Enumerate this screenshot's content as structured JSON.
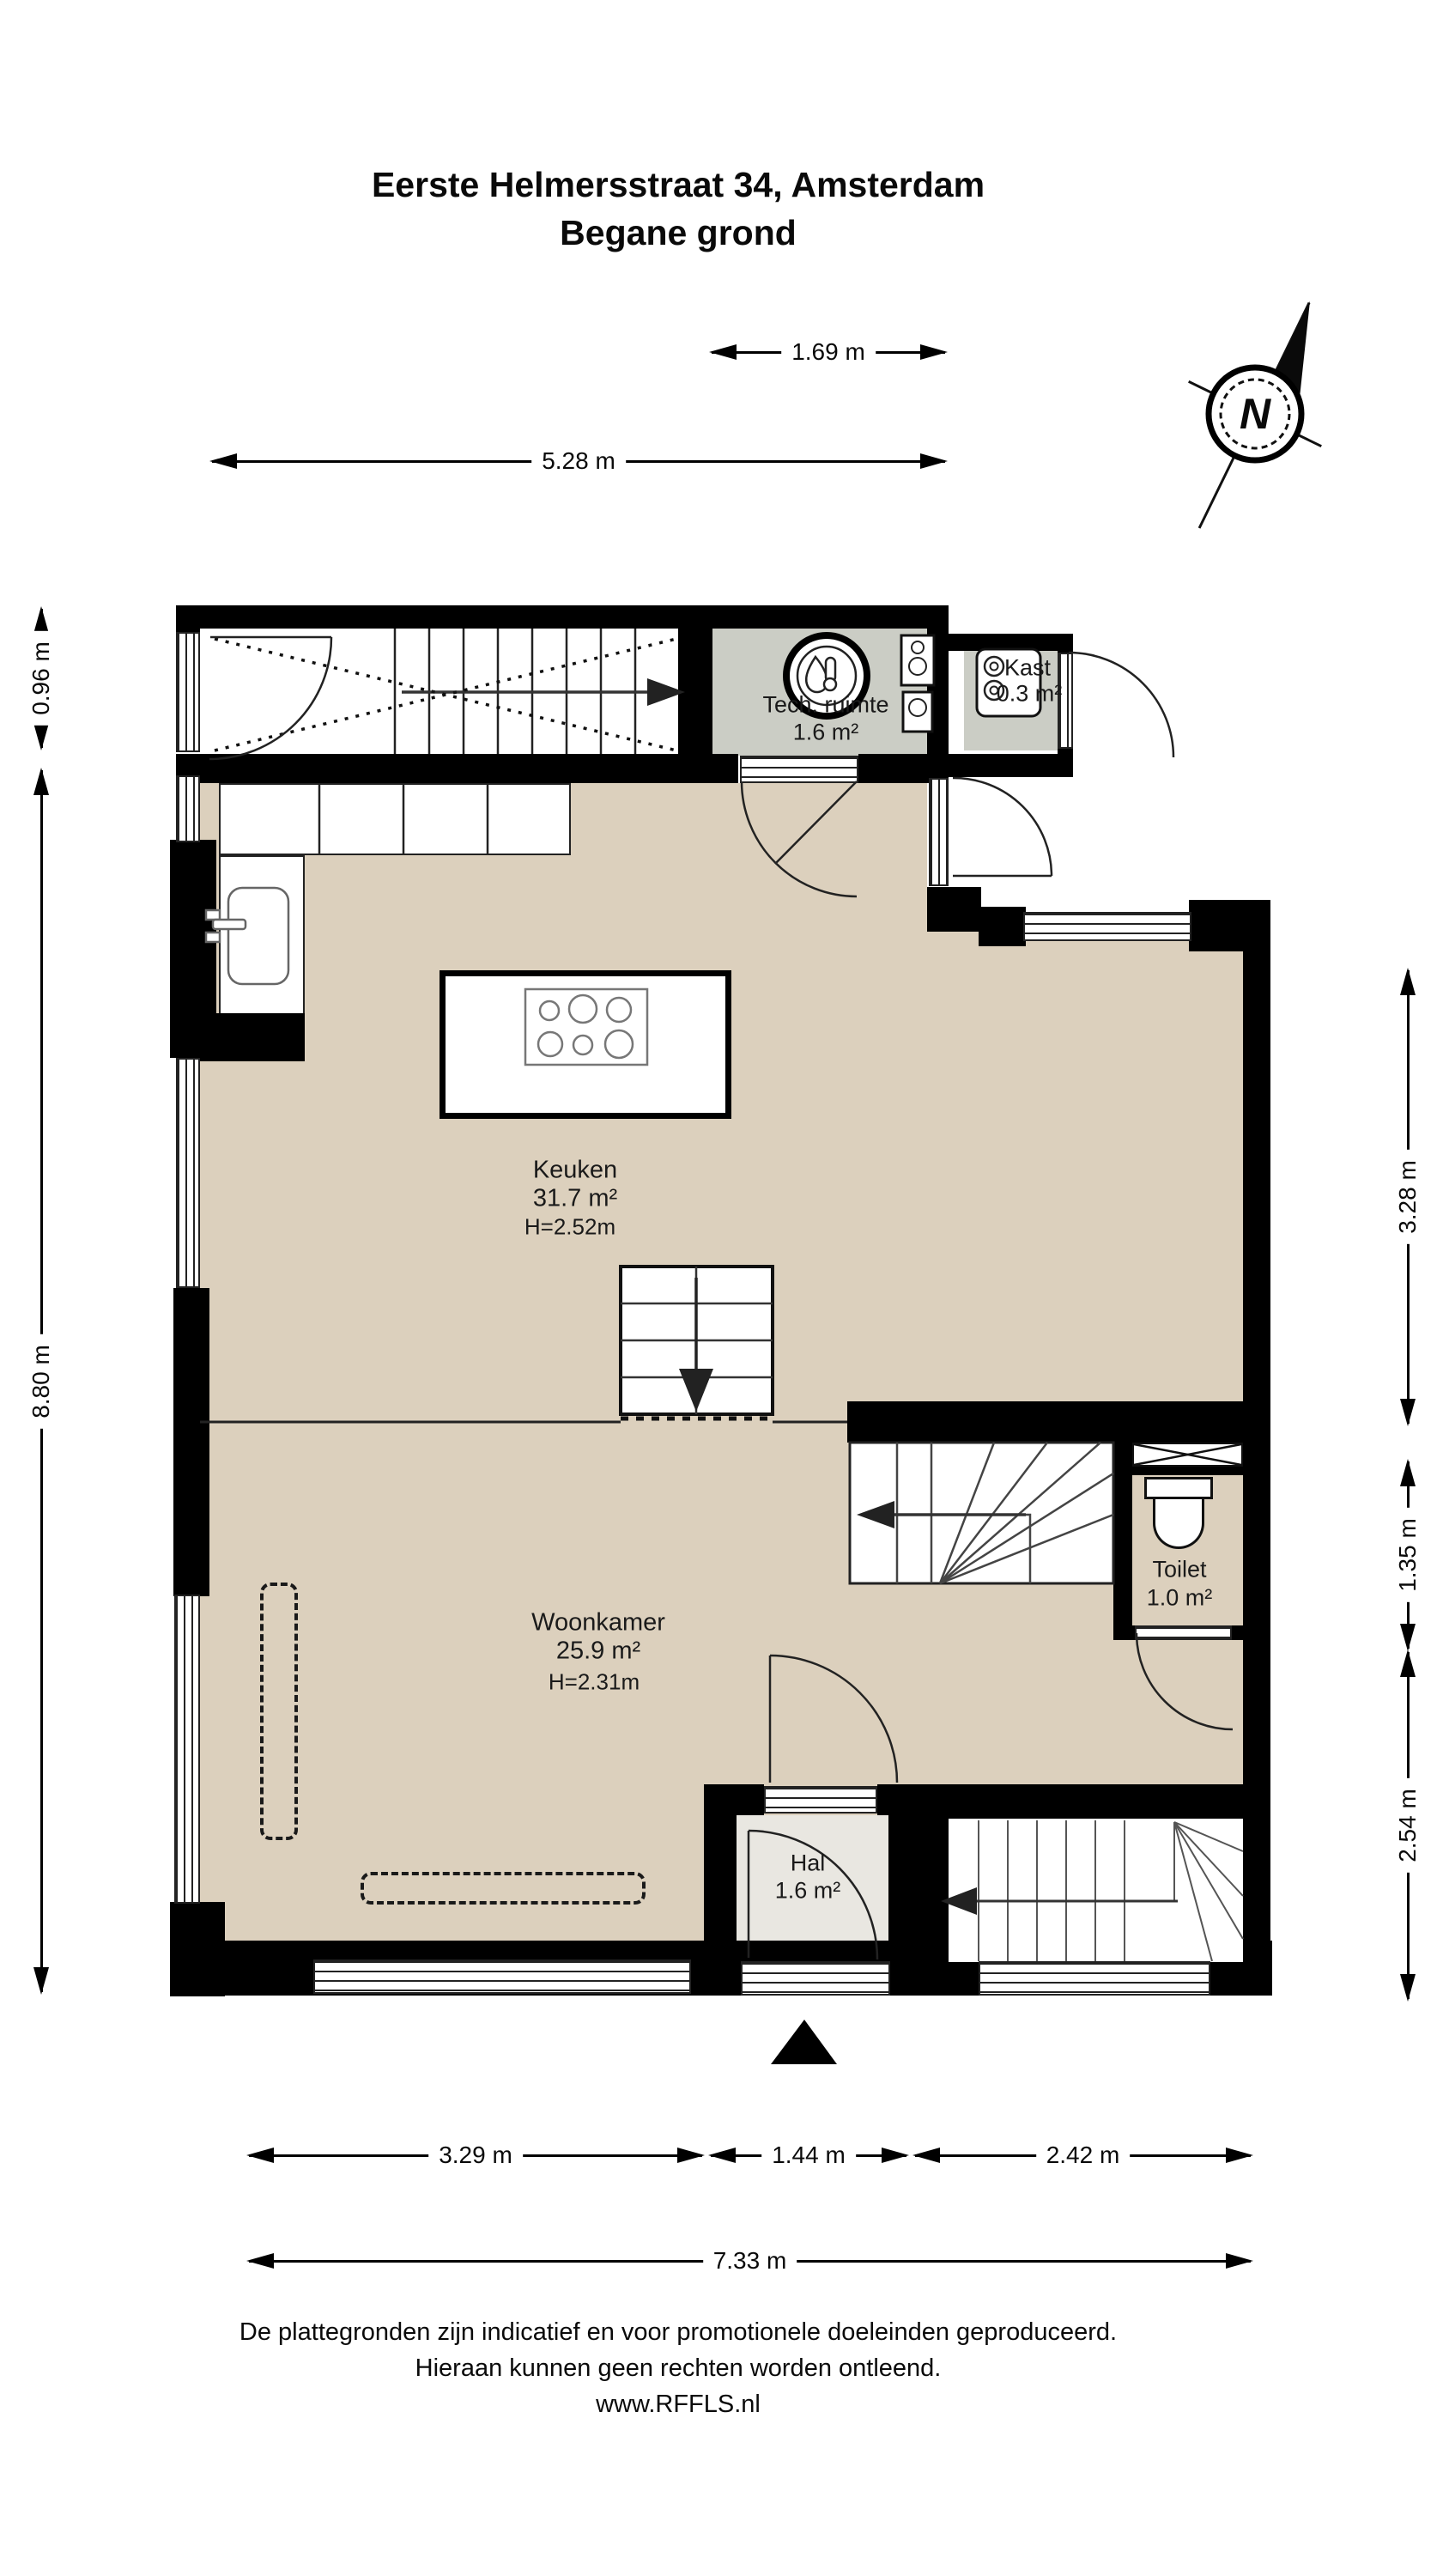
{
  "title": {
    "line1": "Eerste Helmersstraat 34, Amsterdam",
    "line2": "Begane grond"
  },
  "compass": {
    "north_label": "N"
  },
  "dims": {
    "top_small": "1.69 m",
    "top_main": "5.28 m",
    "left_small": "0.96 m",
    "left_main": "8.80 m",
    "right_upper": "3.28 m",
    "right_mid": "1.35 m",
    "right_lower": "2.54 m",
    "bottom_left": "3.29 m",
    "bottom_mid": "1.44 m",
    "bottom_right": "2.42 m",
    "bottom_total": "7.33 m"
  },
  "rooms": {
    "tech": {
      "name": "Tech. ruimte",
      "area": "1.6 m²"
    },
    "kast": {
      "name": "Kast",
      "area": "0.3 m²"
    },
    "keuken": {
      "name": "Keuken",
      "area": "31.7 m²",
      "height": "H=2.52m"
    },
    "woonkamer": {
      "name": "Woonkamer",
      "area": "25.9 m²",
      "height": "H=2.31m"
    },
    "toilet": {
      "name": "Toilet",
      "area": "1.0 m²"
    },
    "hal": {
      "name": "Hal",
      "area": "1.6 m²"
    }
  },
  "footer": {
    "line1": "De plattegronden zijn indicatief en voor promotionele doeleinden geproduceerd.",
    "line2": "Hieraan kunnen geen rechten worden ontleend.",
    "line3": "www.RFFLS.nl"
  },
  "colors": {
    "floor": "#DCD0BD",
    "hal_floor": "#E9E7E1",
    "service_floor": "#CBCDC5",
    "wall": "#000000",
    "line": "#222222"
  }
}
